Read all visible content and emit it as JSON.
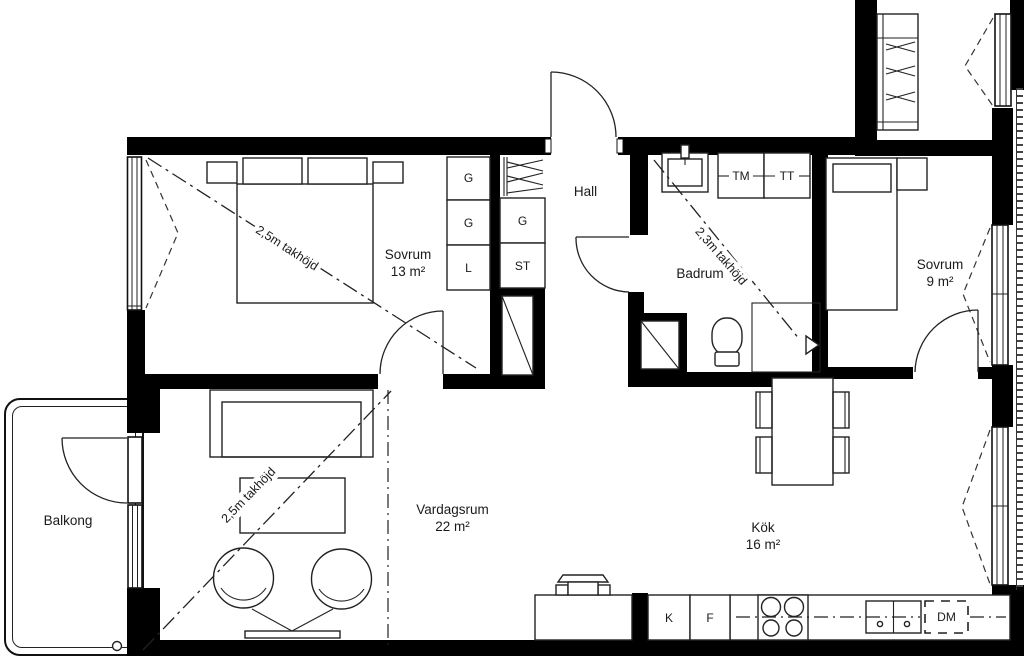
{
  "rooms": {
    "sovrum13": {
      "name": "Sovrum",
      "area": "13 m²",
      "ceiling_note": "2,5m takhöjd"
    },
    "hall": {
      "name": "Hall"
    },
    "badrum": {
      "name": "Badrum",
      "ceiling_note": "2,3m takhöjd"
    },
    "sovrum9": {
      "name": "Sovrum",
      "area": "9 m²"
    },
    "vardagsrum": {
      "name": "Vardagsrum",
      "area": "22 m²",
      "ceiling_note": "2,5m takhöjd"
    },
    "kok": {
      "name": "Kök",
      "area": "16 m²"
    },
    "balkong": {
      "name": "Balkong"
    }
  },
  "storage": {
    "bedroom_closets": [
      "G",
      "G",
      "L"
    ],
    "hall_closets": [
      "G",
      "ST"
    ]
  },
  "appliances": {
    "washer": "TM",
    "dryer": "TT",
    "fridge": "K",
    "freezer": "F",
    "dishwasher": "DM"
  },
  "colors": {
    "wall": "#000000",
    "line": "#222222",
    "background": "#ffffff"
  }
}
